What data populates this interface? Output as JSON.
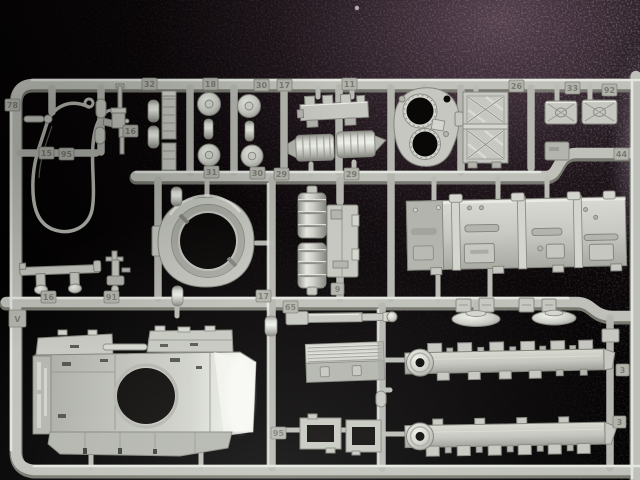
{
  "scene": {
    "description": "Macro photograph of a light-grey injection-moulded plastic model kit sprue (1/35 tank parts runner) lying on a dark leather-textured surface",
    "background": {
      "base_color": "#050303",
      "sheen_color": "#4e3b48",
      "right_glow_color": "#7b6c7a",
      "grain_color": "#c4b2c0",
      "texture": "leather-grain"
    },
    "plastic": {
      "base_color": "#c5c7c0",
      "highlight_color": "#edefe9",
      "shadow_color": "#85877f",
      "hole_color": "#0a0807"
    }
  },
  "parts": [
    {
      "name": "tow-cable-loop"
    },
    {
      "name": "machine-gun"
    },
    {
      "name": "shell-pegs",
      "count": 2
    },
    {
      "name": "ladder-strips",
      "count": 2
    },
    {
      "name": "round-hatch-discs",
      "count": 4
    },
    {
      "name": "spacer-spools",
      "count": 2
    },
    {
      "name": "notched-bracket"
    },
    {
      "name": "exhaust-mufflers",
      "count": 2
    },
    {
      "name": "turret-roof-with-hatch-openings"
    },
    {
      "name": "lattice-grille-box"
    },
    {
      "name": "x-pattern-stowage-boxes",
      "count": 2
    },
    {
      "name": "turret-ring"
    },
    {
      "name": "ribbed-fuel-drums",
      "count": 2
    },
    {
      "name": "access-plate"
    },
    {
      "name": "long-engine-side-panel"
    },
    {
      "name": "bench-bracket"
    },
    {
      "name": "periscope-mount"
    },
    {
      "name": "upper-hull-with-turret-ring-opening"
    },
    {
      "name": "gun-barrel"
    },
    {
      "name": "dome-hatches",
      "count": 2
    },
    {
      "name": "clamp-blocks",
      "count": 4
    },
    {
      "name": "ribbed-stowage-bin"
    },
    {
      "name": "hatch-frames",
      "count": 2
    },
    {
      "name": "side-skirt-rails",
      "count": 2
    }
  ],
  "part_tags": [
    {
      "label": "78"
    },
    {
      "label": "15"
    },
    {
      "label": "95"
    },
    {
      "label": "32"
    },
    {
      "label": "18"
    },
    {
      "label": "30"
    },
    {
      "label": "17"
    },
    {
      "label": "11"
    },
    {
      "label": "26"
    },
    {
      "label": "33"
    },
    {
      "label": "92"
    },
    {
      "label": "31"
    },
    {
      "label": "30"
    },
    {
      "label": "29"
    },
    {
      "label": "29"
    },
    {
      "label": "16"
    },
    {
      "label": "16"
    },
    {
      "label": "91"
    },
    {
      "label": "17"
    },
    {
      "label": "65"
    },
    {
      "label": "9"
    },
    {
      "label": "44"
    },
    {
      "label": "3"
    },
    {
      "label": "3"
    },
    {
      "label": "95"
    },
    {
      "label": "V"
    }
  ]
}
